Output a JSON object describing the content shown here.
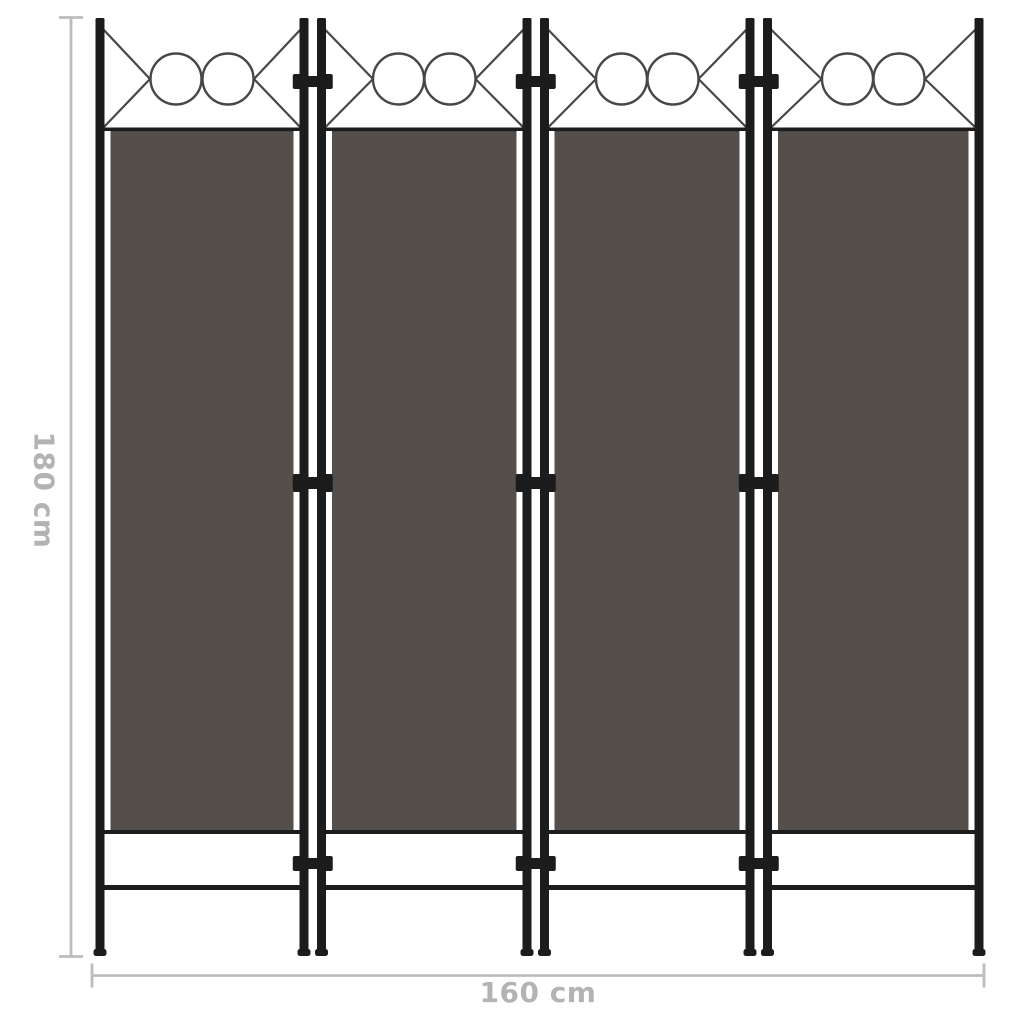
{
  "product_diagram": {
    "subject": "4-panel room divider screen",
    "panel_count": 4,
    "dimensions": {
      "height_label": "180 cm",
      "width_label": "160 cm"
    }
  },
  "colors": {
    "background": "#ffffff",
    "fabric": "#544f4a",
    "fabric_edge": "#3c3936",
    "frame": "#1c1c1c",
    "decor_stroke": "#474747",
    "dimension_line": "#bdbdbd",
    "dimension_text": "#b3b3b3"
  }
}
